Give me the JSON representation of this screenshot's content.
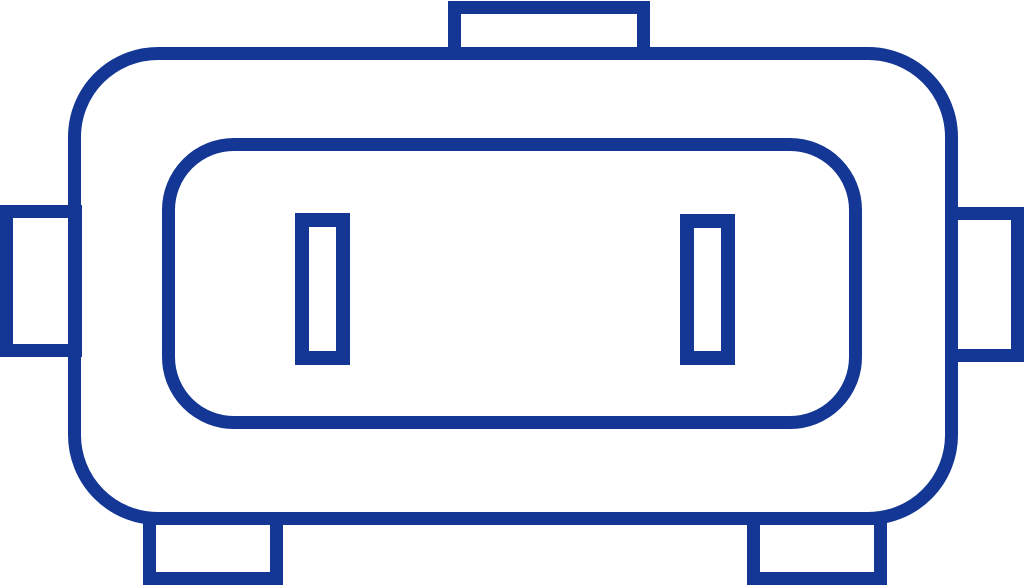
{
  "canvas": {
    "width": 1024,
    "height": 585
  },
  "icon": {
    "name": "connector-sensor-icon",
    "alt": "Blue outline pictogram of a connector / sensor unit: rounded rectangular housing containing an inner rounded panel with two vertical pin slots, a tab on top, tabs on the left and right sides, and two mounting feet at the bottom",
    "colors": {
      "stroke": "#143795",
      "background": "#FFFFFF"
    }
  }
}
